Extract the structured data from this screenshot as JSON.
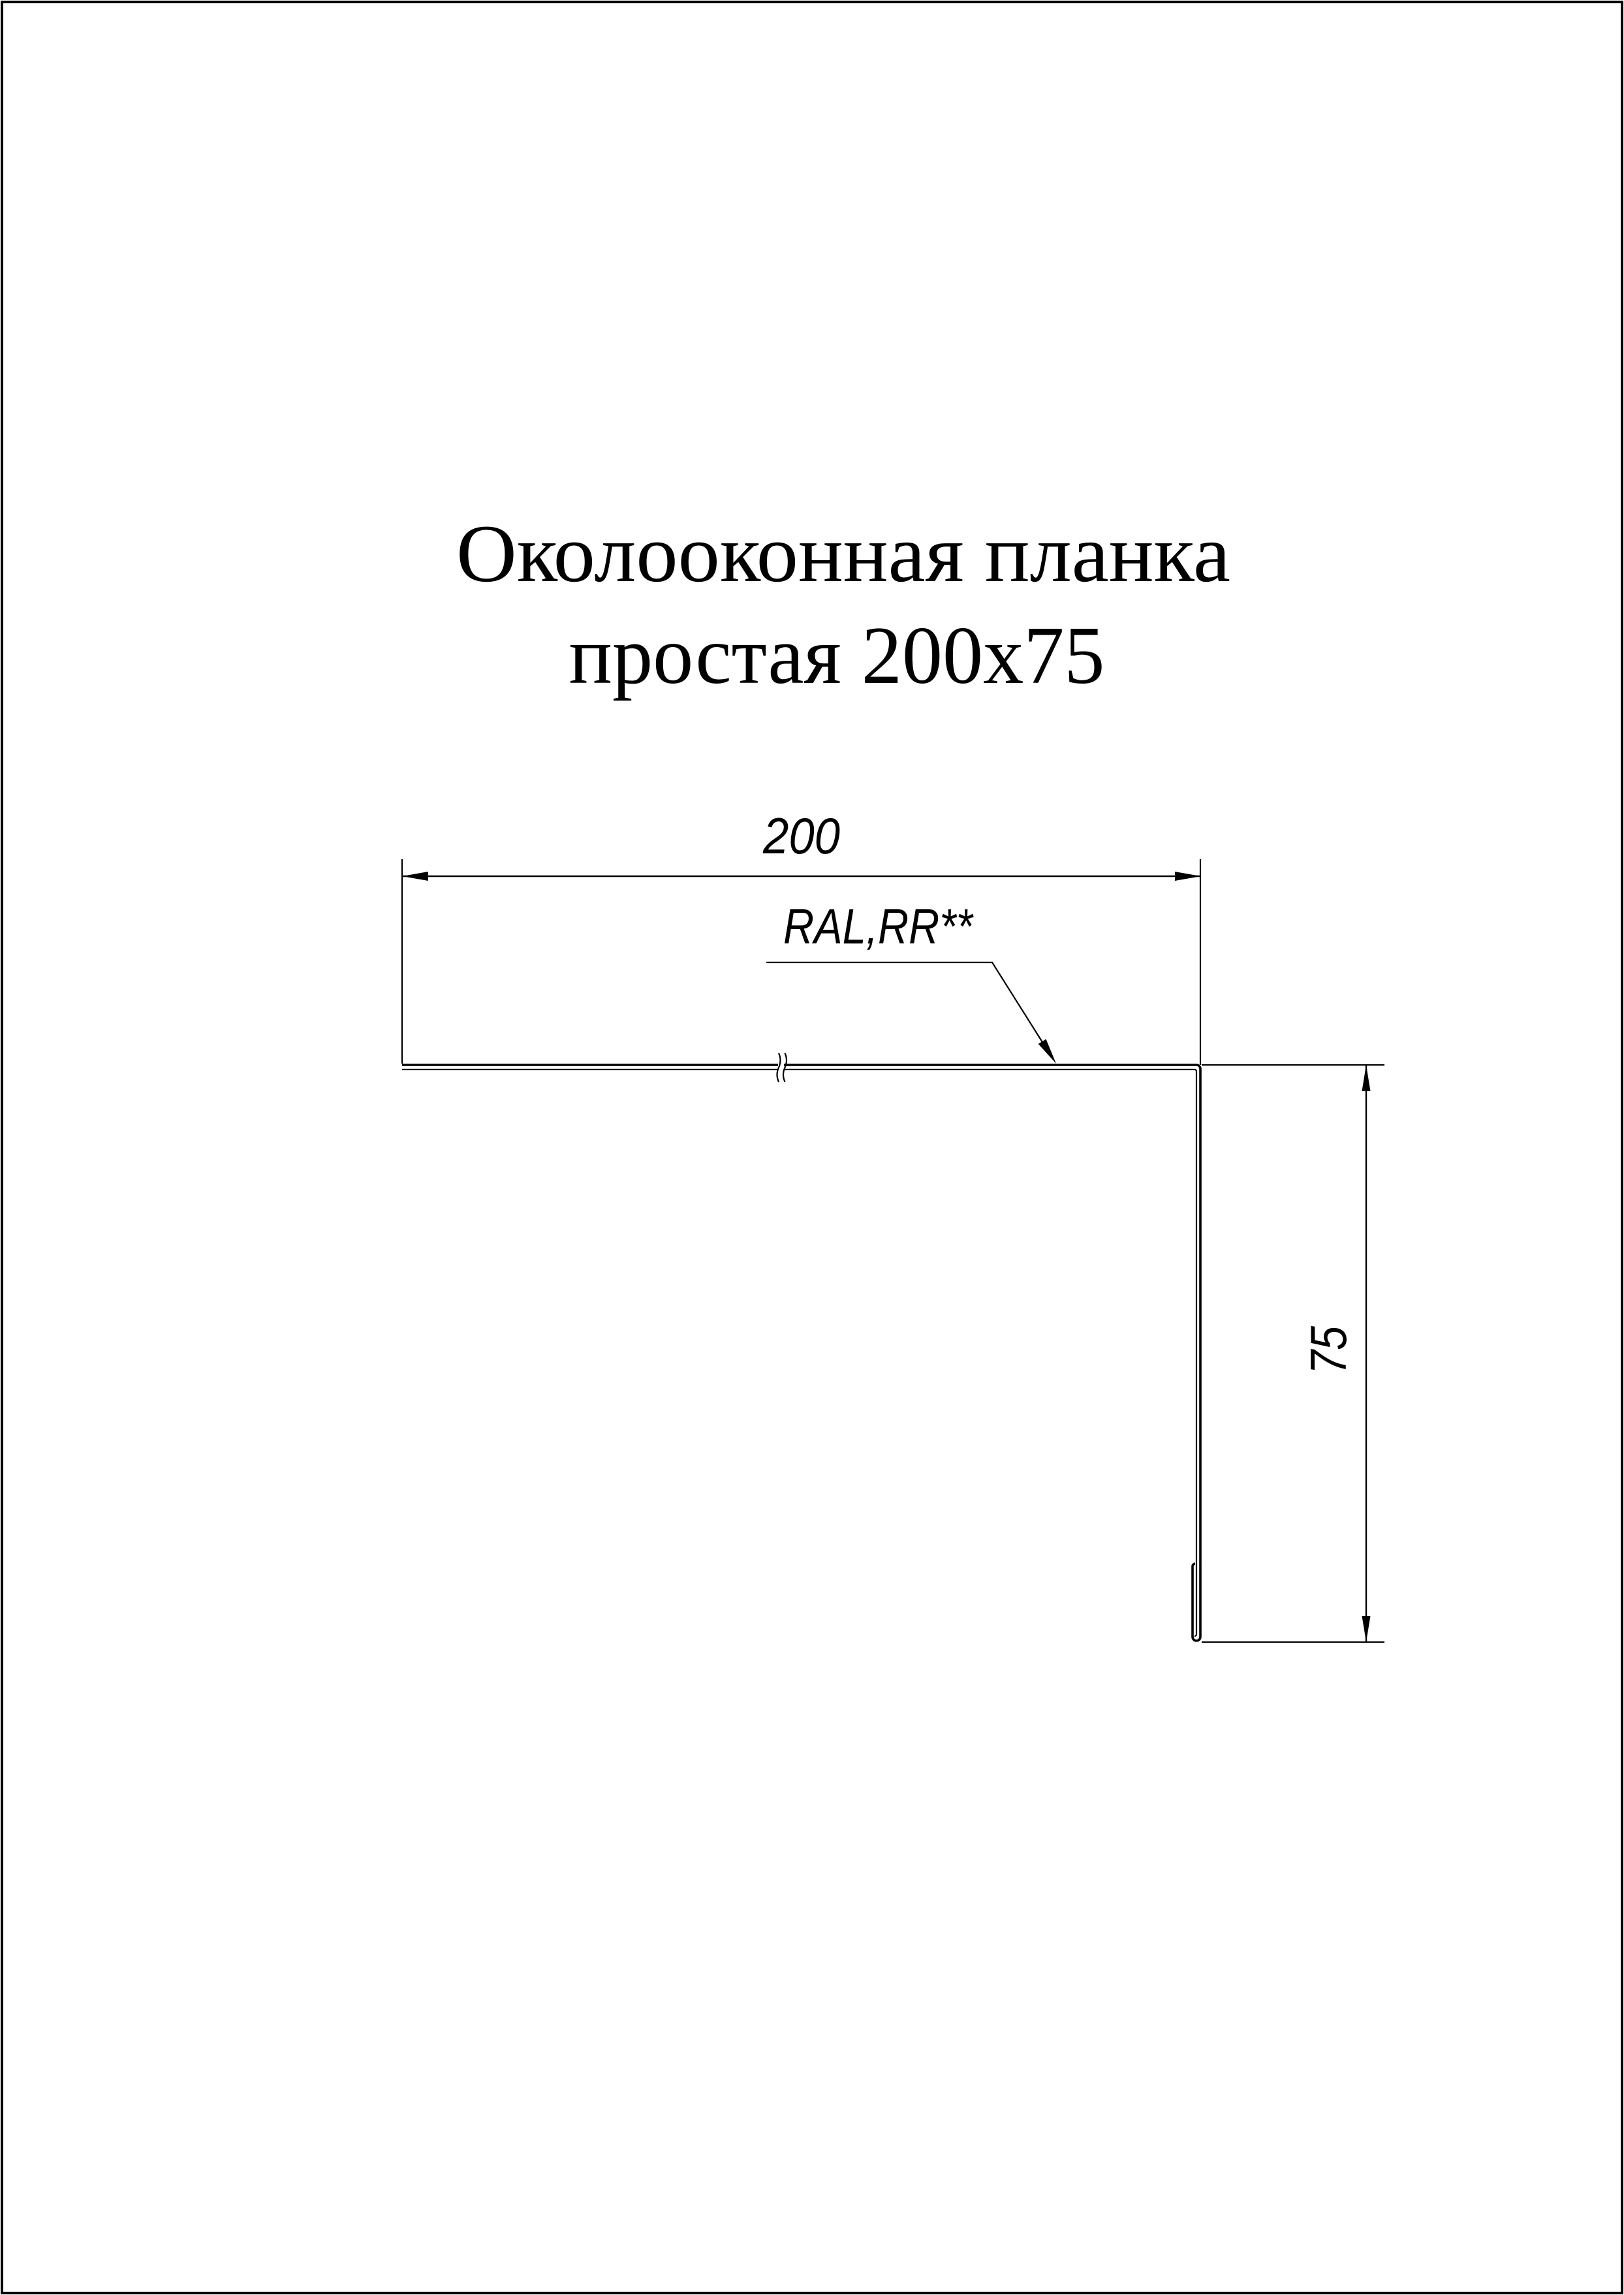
{
  "page": {
    "background_color": "#ffffff",
    "line_color": "#000000"
  },
  "title": {
    "line1": "Околооконная планка",
    "line2": "простая 200х75"
  },
  "product": {
    "name": "Околооконная планка простая 200х75",
    "flange_width_mm": 200,
    "leg_height_mm": 75
  },
  "dimensions": {
    "width": {
      "value": "200"
    },
    "height": {
      "value": "75"
    }
  },
  "labels": {
    "coating": "RAL,RR**"
  }
}
